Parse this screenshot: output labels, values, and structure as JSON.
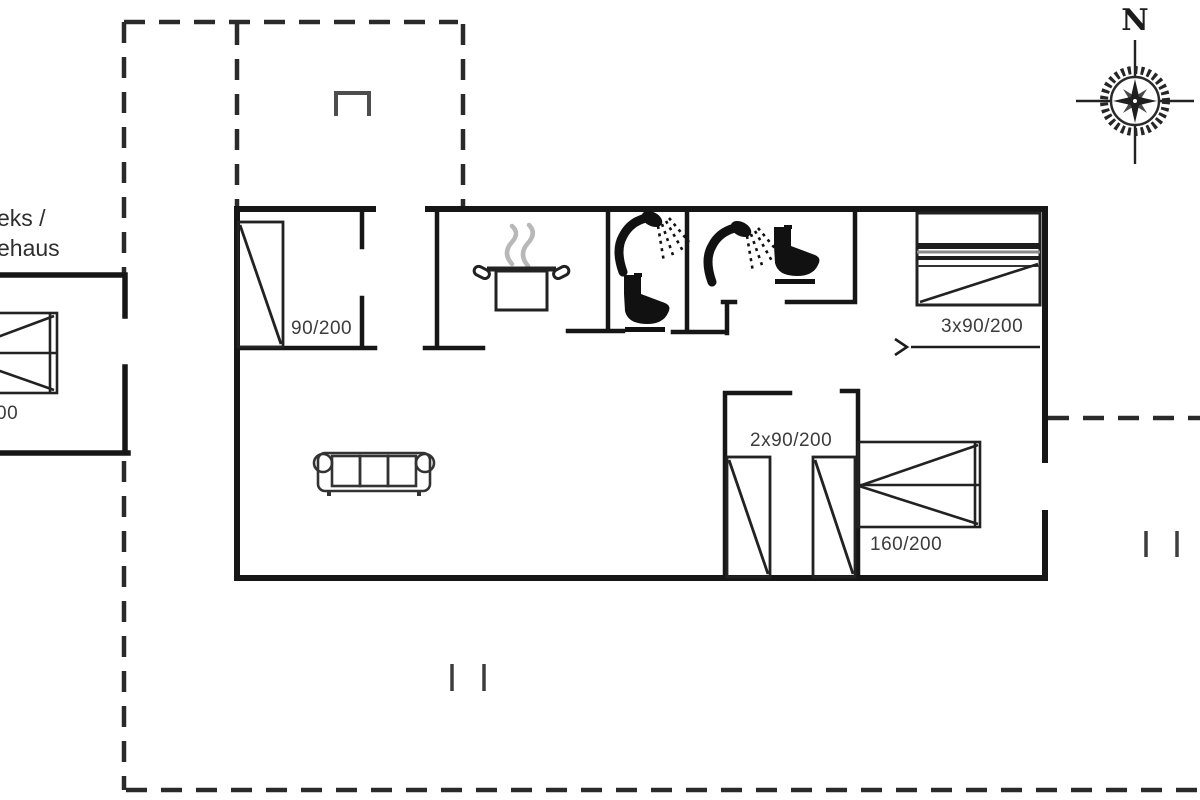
{
  "compass": {
    "north_label": "N"
  },
  "annex": {
    "label_line1": "eks /",
    "label_line2": "ehaus",
    "bed_label": "00"
  },
  "labels": {
    "bedroom1_bed": "90/200",
    "bunk_bed": "3x90/200",
    "twin_beds": "2x90/200",
    "double_bed": "160/200"
  },
  "icons": {
    "compass-rose-icon": "compass rose with N-S / E-W cross",
    "stove-pot-icon": "cooking pot with steam",
    "shower-icon": "shower head spraying water",
    "toilet-icon": "toilet silhouette",
    "sofa-icon": "three-seat sofa",
    "single-bed-icon": "single bed with diagonal",
    "bunk-bed-icon": "bunk bed",
    "double-bed-icon": "double bed",
    "chimney-icon": "open rectangle marker",
    "sliding-door-arrow-icon": "arrow with track line",
    "boundary-tick-icon": "pair of short vertical ticks"
  },
  "colors": {
    "wall": "#161616",
    "boundary_dash": "#2a2a2a",
    "furniture": "#222222",
    "steam": "#b8b8b8",
    "label_text": "#3c3c3c",
    "background": "#ffffff"
  }
}
